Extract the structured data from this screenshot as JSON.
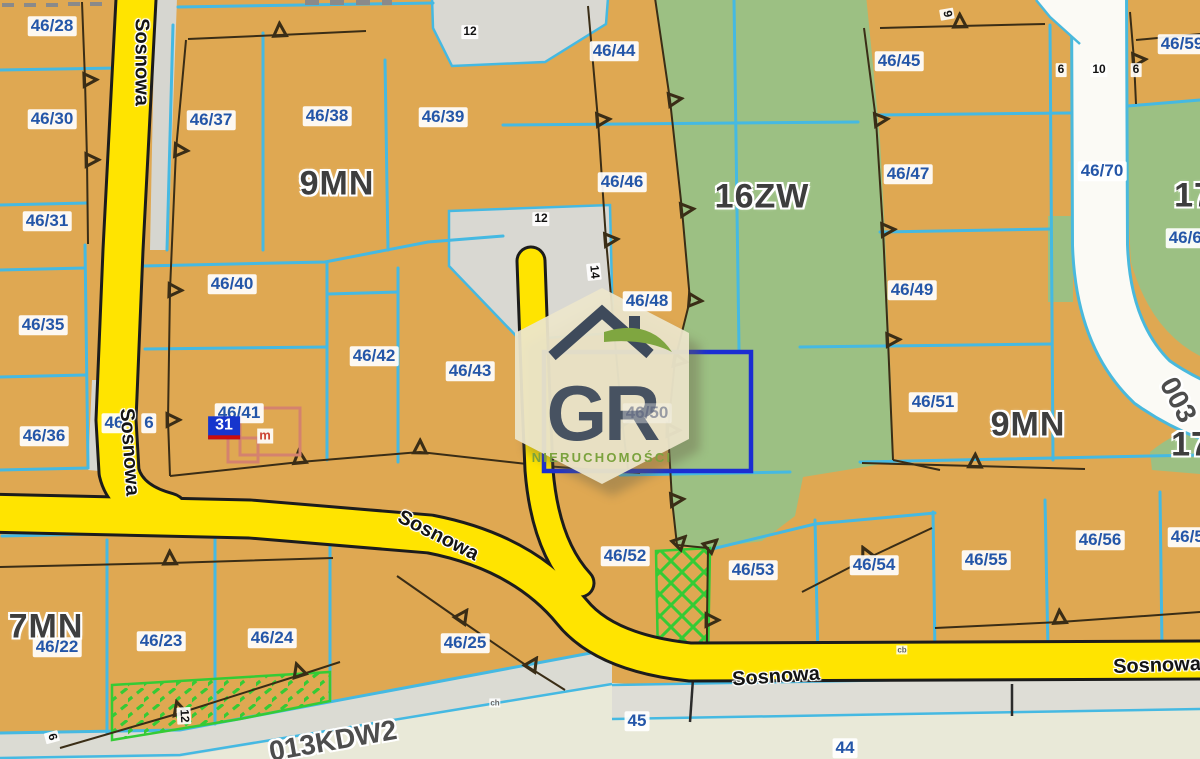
{
  "map": {
    "labels": [
      {
        "t": "46/28",
        "x": 52,
        "y": 26,
        "k": "parcel"
      },
      {
        "t": "46/30",
        "x": 52,
        "y": 119,
        "k": "parcel"
      },
      {
        "t": "46/31",
        "x": 47,
        "y": 221,
        "k": "parcel"
      },
      {
        "t": "46/35",
        "x": 43,
        "y": 325,
        "k": "parcel"
      },
      {
        "t": "46/36",
        "x": 44,
        "y": 436,
        "k": "parcel"
      },
      {
        "t": "46/37",
        "x": 211,
        "y": 120,
        "k": "parcel"
      },
      {
        "t": "46/38",
        "x": 327,
        "y": 116,
        "k": "parcel"
      },
      {
        "t": "46/39",
        "x": 443,
        "y": 117,
        "k": "parcel"
      },
      {
        "t": "46/40",
        "x": 232,
        "y": 284,
        "k": "parcel"
      },
      {
        "t": "46/41",
        "x": 239,
        "y": 413,
        "k": "parcel"
      },
      {
        "t": "46",
        "x": 114,
        "y": 423,
        "k": "parcel"
      },
      {
        "t": "6",
        "x": 149,
        "y": 423,
        "k": "parcel"
      },
      {
        "t": "46/42",
        "x": 374,
        "y": 356,
        "k": "parcel"
      },
      {
        "t": "46/43",
        "x": 470,
        "y": 371,
        "k": "parcel"
      },
      {
        "t": "46/44",
        "x": 614,
        "y": 51,
        "k": "parcel"
      },
      {
        "t": "46/45",
        "x": 899,
        "y": 61,
        "k": "parcel"
      },
      {
        "t": "46/46",
        "x": 622,
        "y": 182,
        "k": "parcel"
      },
      {
        "t": "46/47",
        "x": 908,
        "y": 174,
        "k": "parcel"
      },
      {
        "t": "46/48",
        "x": 647,
        "y": 301,
        "k": "parcel"
      },
      {
        "t": "46/49",
        "x": 912,
        "y": 290,
        "k": "parcel"
      },
      {
        "t": "46/50",
        "x": 647,
        "y": 413,
        "k": "parceldim"
      },
      {
        "t": "46/51",
        "x": 933,
        "y": 402,
        "k": "parcel"
      },
      {
        "t": "46/52",
        "x": 625,
        "y": 556,
        "k": "parcel"
      },
      {
        "t": "46/53",
        "x": 753,
        "y": 570,
        "k": "parcel"
      },
      {
        "t": "46/54",
        "x": 874,
        "y": 565,
        "k": "parcel"
      },
      {
        "t": "46/55",
        "x": 986,
        "y": 560,
        "k": "parcel"
      },
      {
        "t": "46/56",
        "x": 1100,
        "y": 540,
        "k": "parcel"
      },
      {
        "t": "46/57",
        "x": 1192,
        "y": 537,
        "k": "parcel"
      },
      {
        "t": "46/59",
        "x": 1182,
        "y": 44,
        "k": "parcel"
      },
      {
        "t": "46/70",
        "x": 1102,
        "y": 171,
        "k": "parcel"
      },
      {
        "t": "46/60",
        "x": 1190,
        "y": 238,
        "k": "parcel"
      },
      {
        "t": "46/22",
        "x": 57,
        "y": 647,
        "k": "parcel"
      },
      {
        "t": "46/23",
        "x": 161,
        "y": 641,
        "k": "parcel"
      },
      {
        "t": "46/24",
        "x": 272,
        "y": 638,
        "k": "parcel"
      },
      {
        "t": "46/25",
        "x": 465,
        "y": 643,
        "k": "parcel"
      },
      {
        "t": "45",
        "x": 637,
        "y": 721,
        "k": "parcel"
      },
      {
        "t": "44",
        "x": 845,
        "y": 748,
        "k": "parcel"
      },
      {
        "t": "9MN",
        "x": 337,
        "y": 184,
        "k": "zone"
      },
      {
        "t": "16ZW",
        "x": 762,
        "y": 197,
        "k": "zone"
      },
      {
        "t": "9MN",
        "x": 1028,
        "y": 425,
        "k": "zone"
      },
      {
        "t": "7MN",
        "x": 46,
        "y": 627,
        "k": "zone"
      },
      {
        "t": "17",
        "x": 1194,
        "y": 196,
        "k": "zone"
      },
      {
        "t": "17",
        "x": 1191,
        "y": 445,
        "k": "zone"
      },
      {
        "t": "Sosnowa",
        "x": 141,
        "y": 62,
        "k": "road",
        "r": 90
      },
      {
        "t": "Sosnowa",
        "x": 129,
        "y": 452,
        "k": "road",
        "r": 86
      },
      {
        "t": "Sosnowa",
        "x": 438,
        "y": 536,
        "k": "road",
        "r": 27
      },
      {
        "t": "Sosnowa",
        "x": 776,
        "y": 677,
        "k": "road",
        "r": -4
      },
      {
        "t": "Sosnowa",
        "x": 1157,
        "y": 666,
        "k": "road",
        "r": -2
      },
      {
        "t": "013KDW2",
        "x": 333,
        "y": 741,
        "k": "roadgray",
        "r": -10
      },
      {
        "t": "003",
        "x": 1178,
        "y": 400,
        "k": "roadgray",
        "r": 62
      },
      {
        "t": "12",
        "x": 470,
        "y": 32,
        "k": "dim"
      },
      {
        "t": "12",
        "x": 541,
        "y": 219,
        "k": "dim"
      },
      {
        "t": "14",
        "x": 594,
        "y": 272,
        "k": "dim",
        "r": 84
      },
      {
        "t": "9",
        "x": 947,
        "y": 14,
        "k": "dim",
        "r": 80
      },
      {
        "t": "6",
        "x": 1061,
        "y": 70,
        "k": "dim"
      },
      {
        "t": "10",
        "x": 1099,
        "y": 70,
        "k": "dim"
      },
      {
        "t": "6",
        "x": 1136,
        "y": 70,
        "k": "dim"
      },
      {
        "t": "12",
        "x": 184,
        "y": 716,
        "k": "dim",
        "r": 87
      },
      {
        "t": "6",
        "x": 52,
        "y": 737,
        "k": "dim",
        "r": 75
      },
      {
        "t": "ch",
        "x": 495,
        "y": 703,
        "k": "tiny"
      },
      {
        "t": "cb",
        "x": 902,
        "y": 650,
        "k": "tiny"
      },
      {
        "t": "31",
        "x": 224,
        "y": 428,
        "k": "badge"
      },
      {
        "t": "m",
        "x": 265,
        "y": 436,
        "k": "mark"
      }
    ]
  },
  "watermark": {
    "letters": "GR",
    "subtitle": "NIERUCHOMOŚCI"
  },
  "colors": {
    "parcel_fill": "#dfa852",
    "green_zone": "#9cc083",
    "road_yellow": "#ffe400",
    "line_cyan": "#45b9e2",
    "label_blue": "#2456a8",
    "highlight_blue": "#1b2ed2",
    "hatch_green": "#35cb35",
    "watermark_cream": "#ece5cb",
    "watermark_dark": "#475261",
    "watermark_green": "#7ba23d"
  }
}
